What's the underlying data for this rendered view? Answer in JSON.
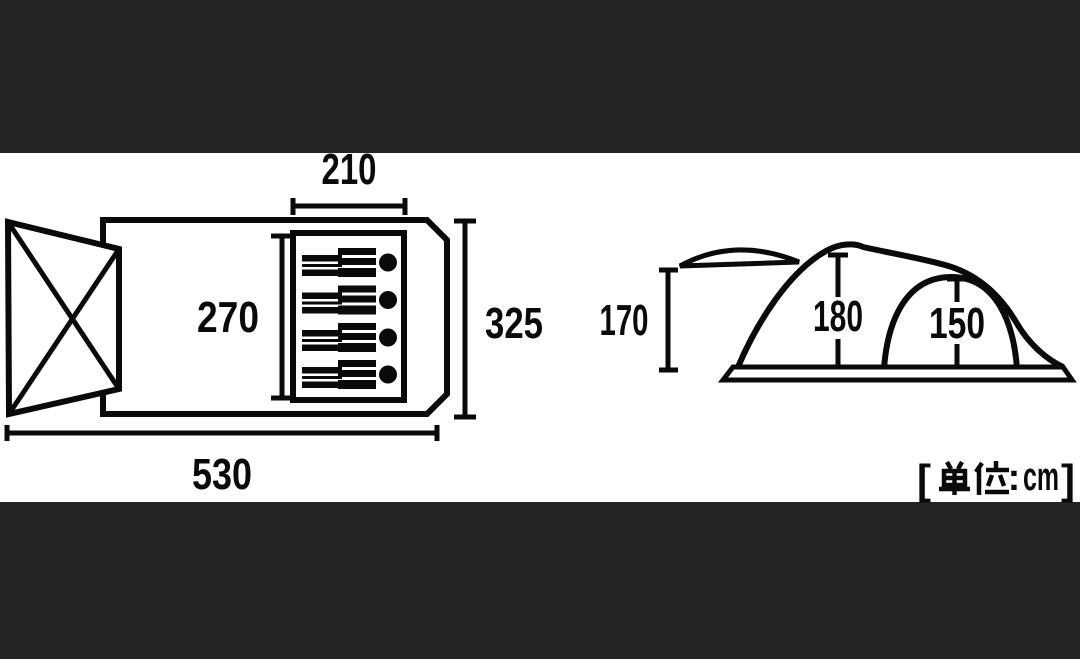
{
  "colors": {
    "letterbox_bar": "#242424",
    "background": "#ffffff",
    "line": "#0a0a0a"
  },
  "floor_plan": {
    "dim_inner_width": "210",
    "dim_inner_depth": "270",
    "dim_overall_width": "325",
    "dim_overall_length": "530",
    "sleeping_bag_count": "4"
  },
  "side_view": {
    "dim_front_height": "170",
    "dim_peak_height": "180",
    "dim_inner_height": "150"
  },
  "unit_label": {
    "open_bracket": "[",
    "kanji": "単位",
    "separator": ":",
    "unit": "cm",
    "close_bracket": "]",
    "full_text": "[単位:cm]"
  }
}
